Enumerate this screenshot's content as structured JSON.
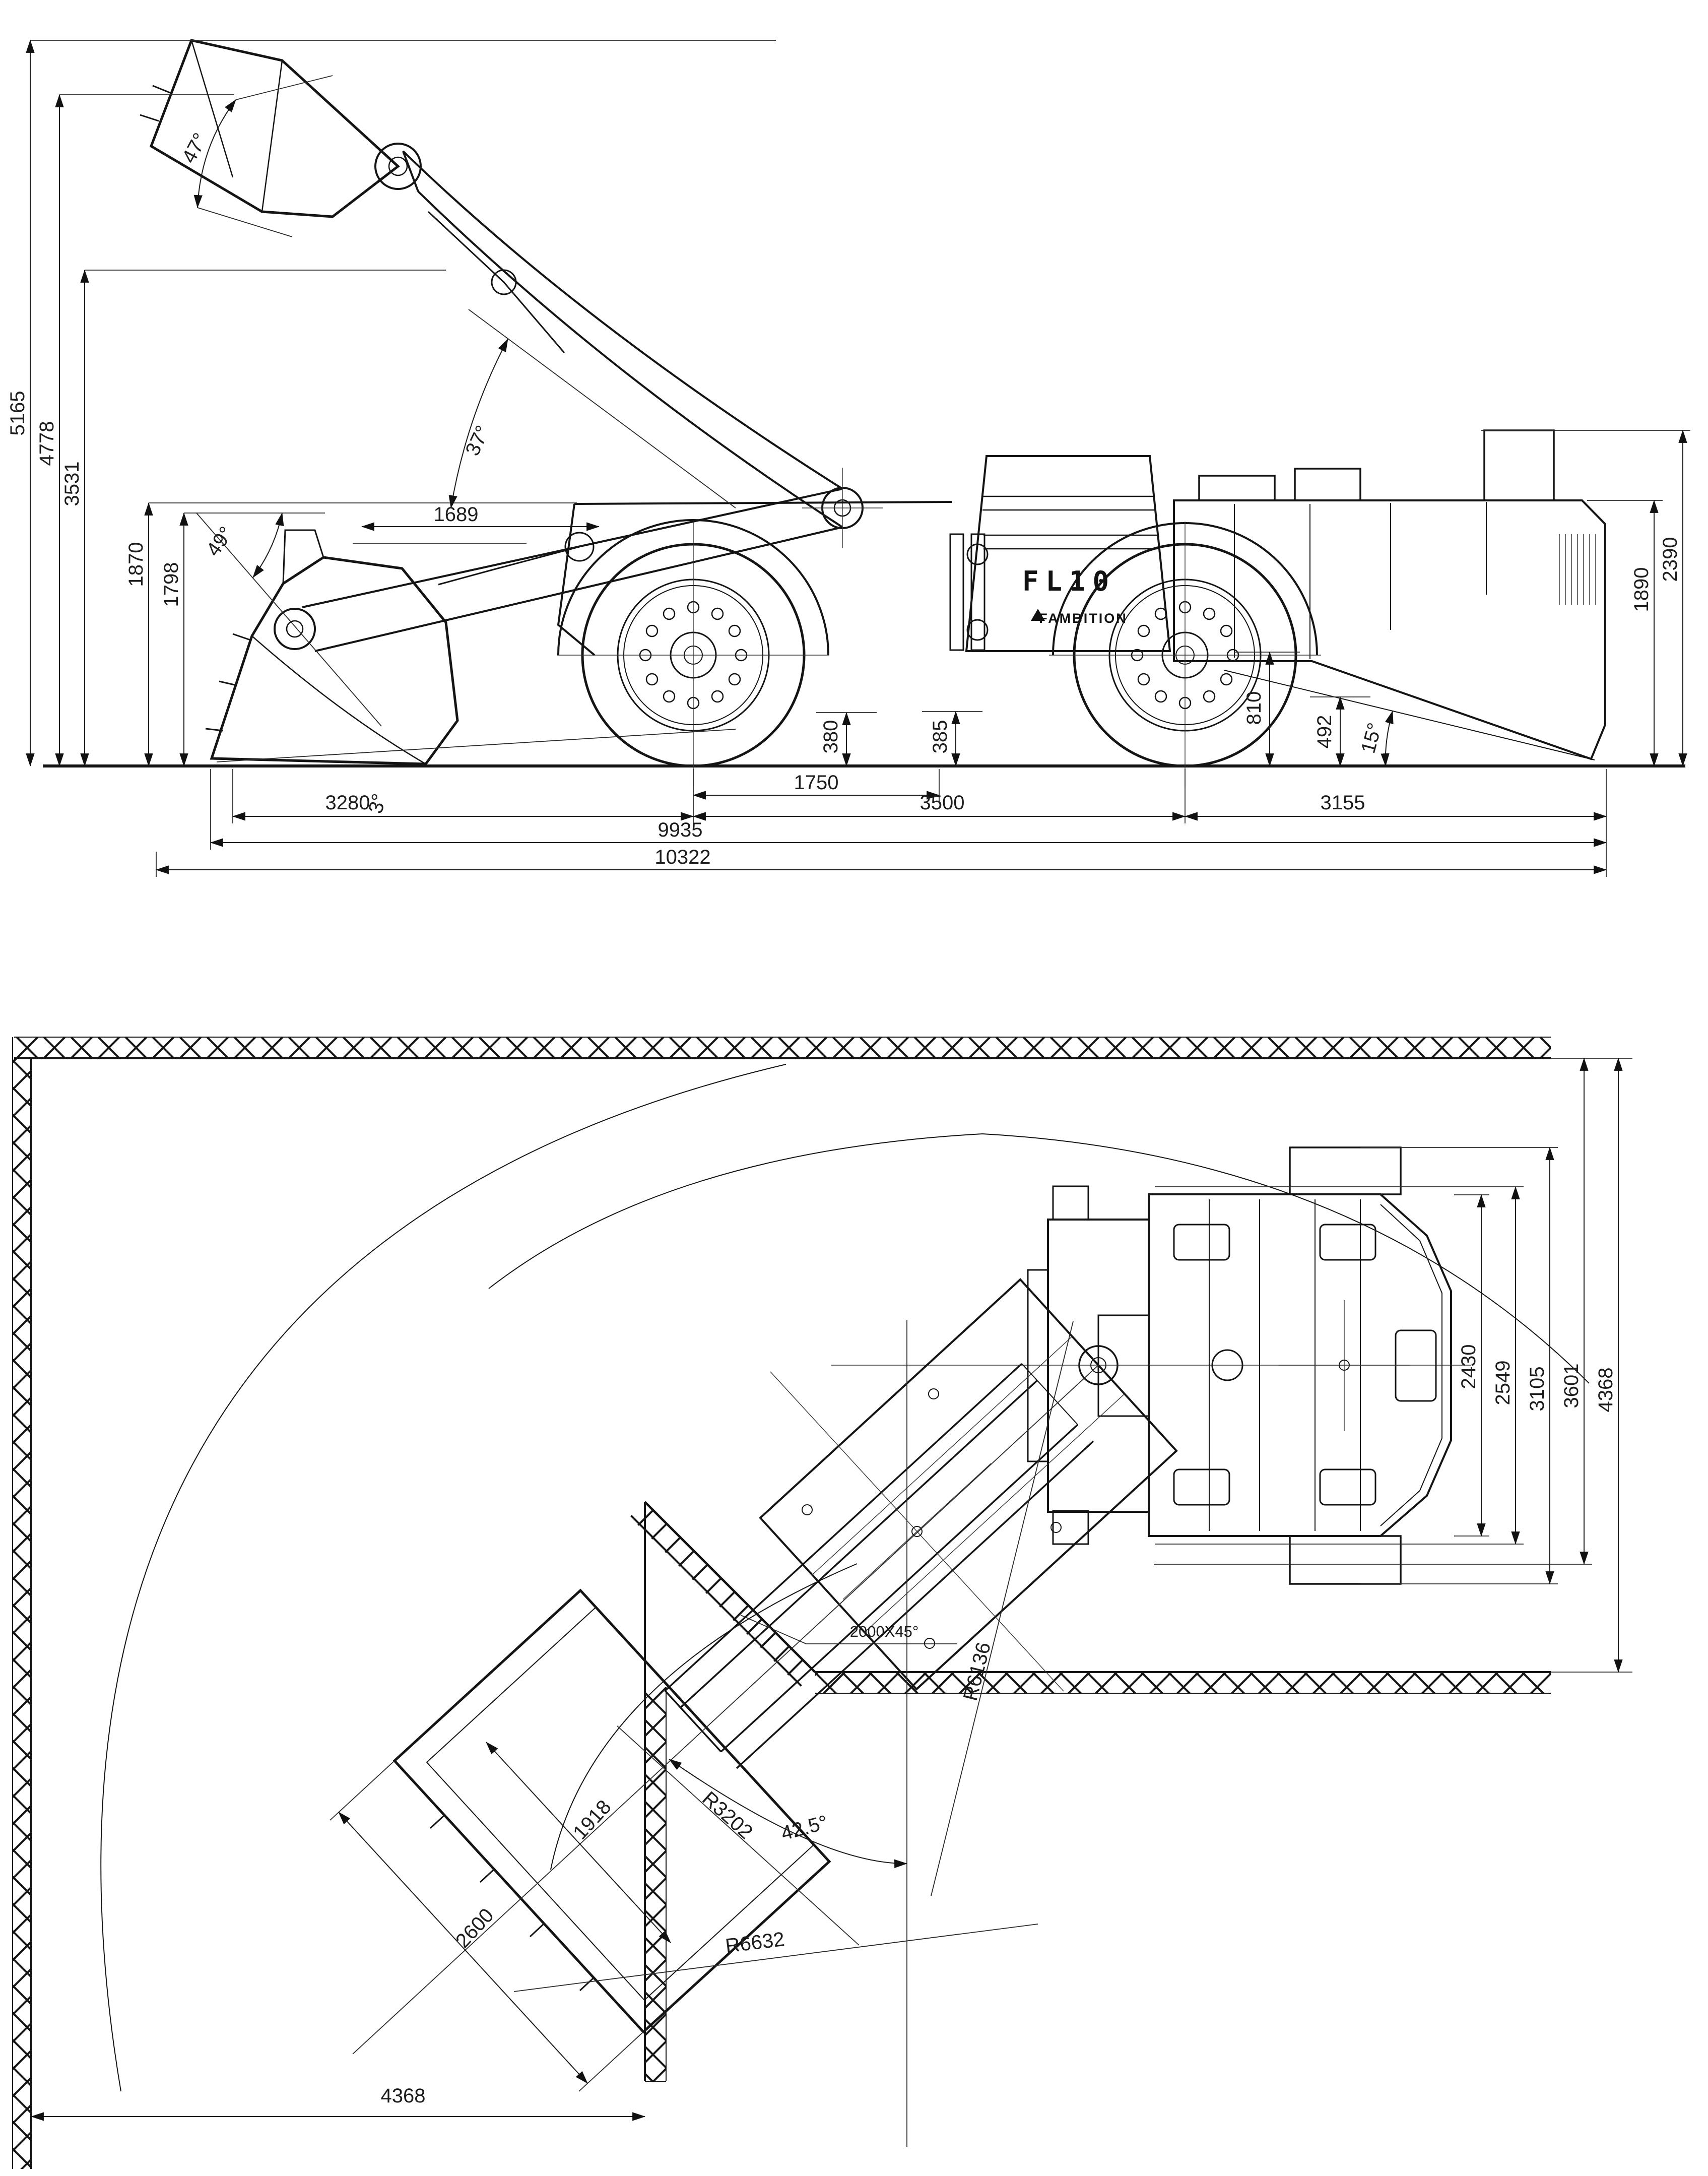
{
  "side": {
    "model": "FL10",
    "brand": "FAMBITION",
    "heights": [
      "5165",
      "4778",
      "3531",
      "1870",
      "1798"
    ],
    "clearances": [
      "380",
      "385",
      "810",
      "492"
    ],
    "rear_heights": [
      "2390",
      "1890"
    ],
    "lengths": [
      "3280",
      "1750",
      "3500",
      "3155",
      "9935",
      "10322"
    ],
    "angles": [
      "47°",
      "37°",
      "49°",
      "3°",
      "15°"
    ],
    "reach": "1689"
  },
  "plan": {
    "widths": [
      "2430",
      "2549",
      "3105",
      "3601",
      "4368"
    ],
    "bucket": [
      "1918",
      "2600"
    ],
    "drift": "4368",
    "radii": [
      "R3202",
      "R6632",
      "R6136"
    ],
    "angle": "42.5°",
    "chamfer": "2000X45°"
  }
}
